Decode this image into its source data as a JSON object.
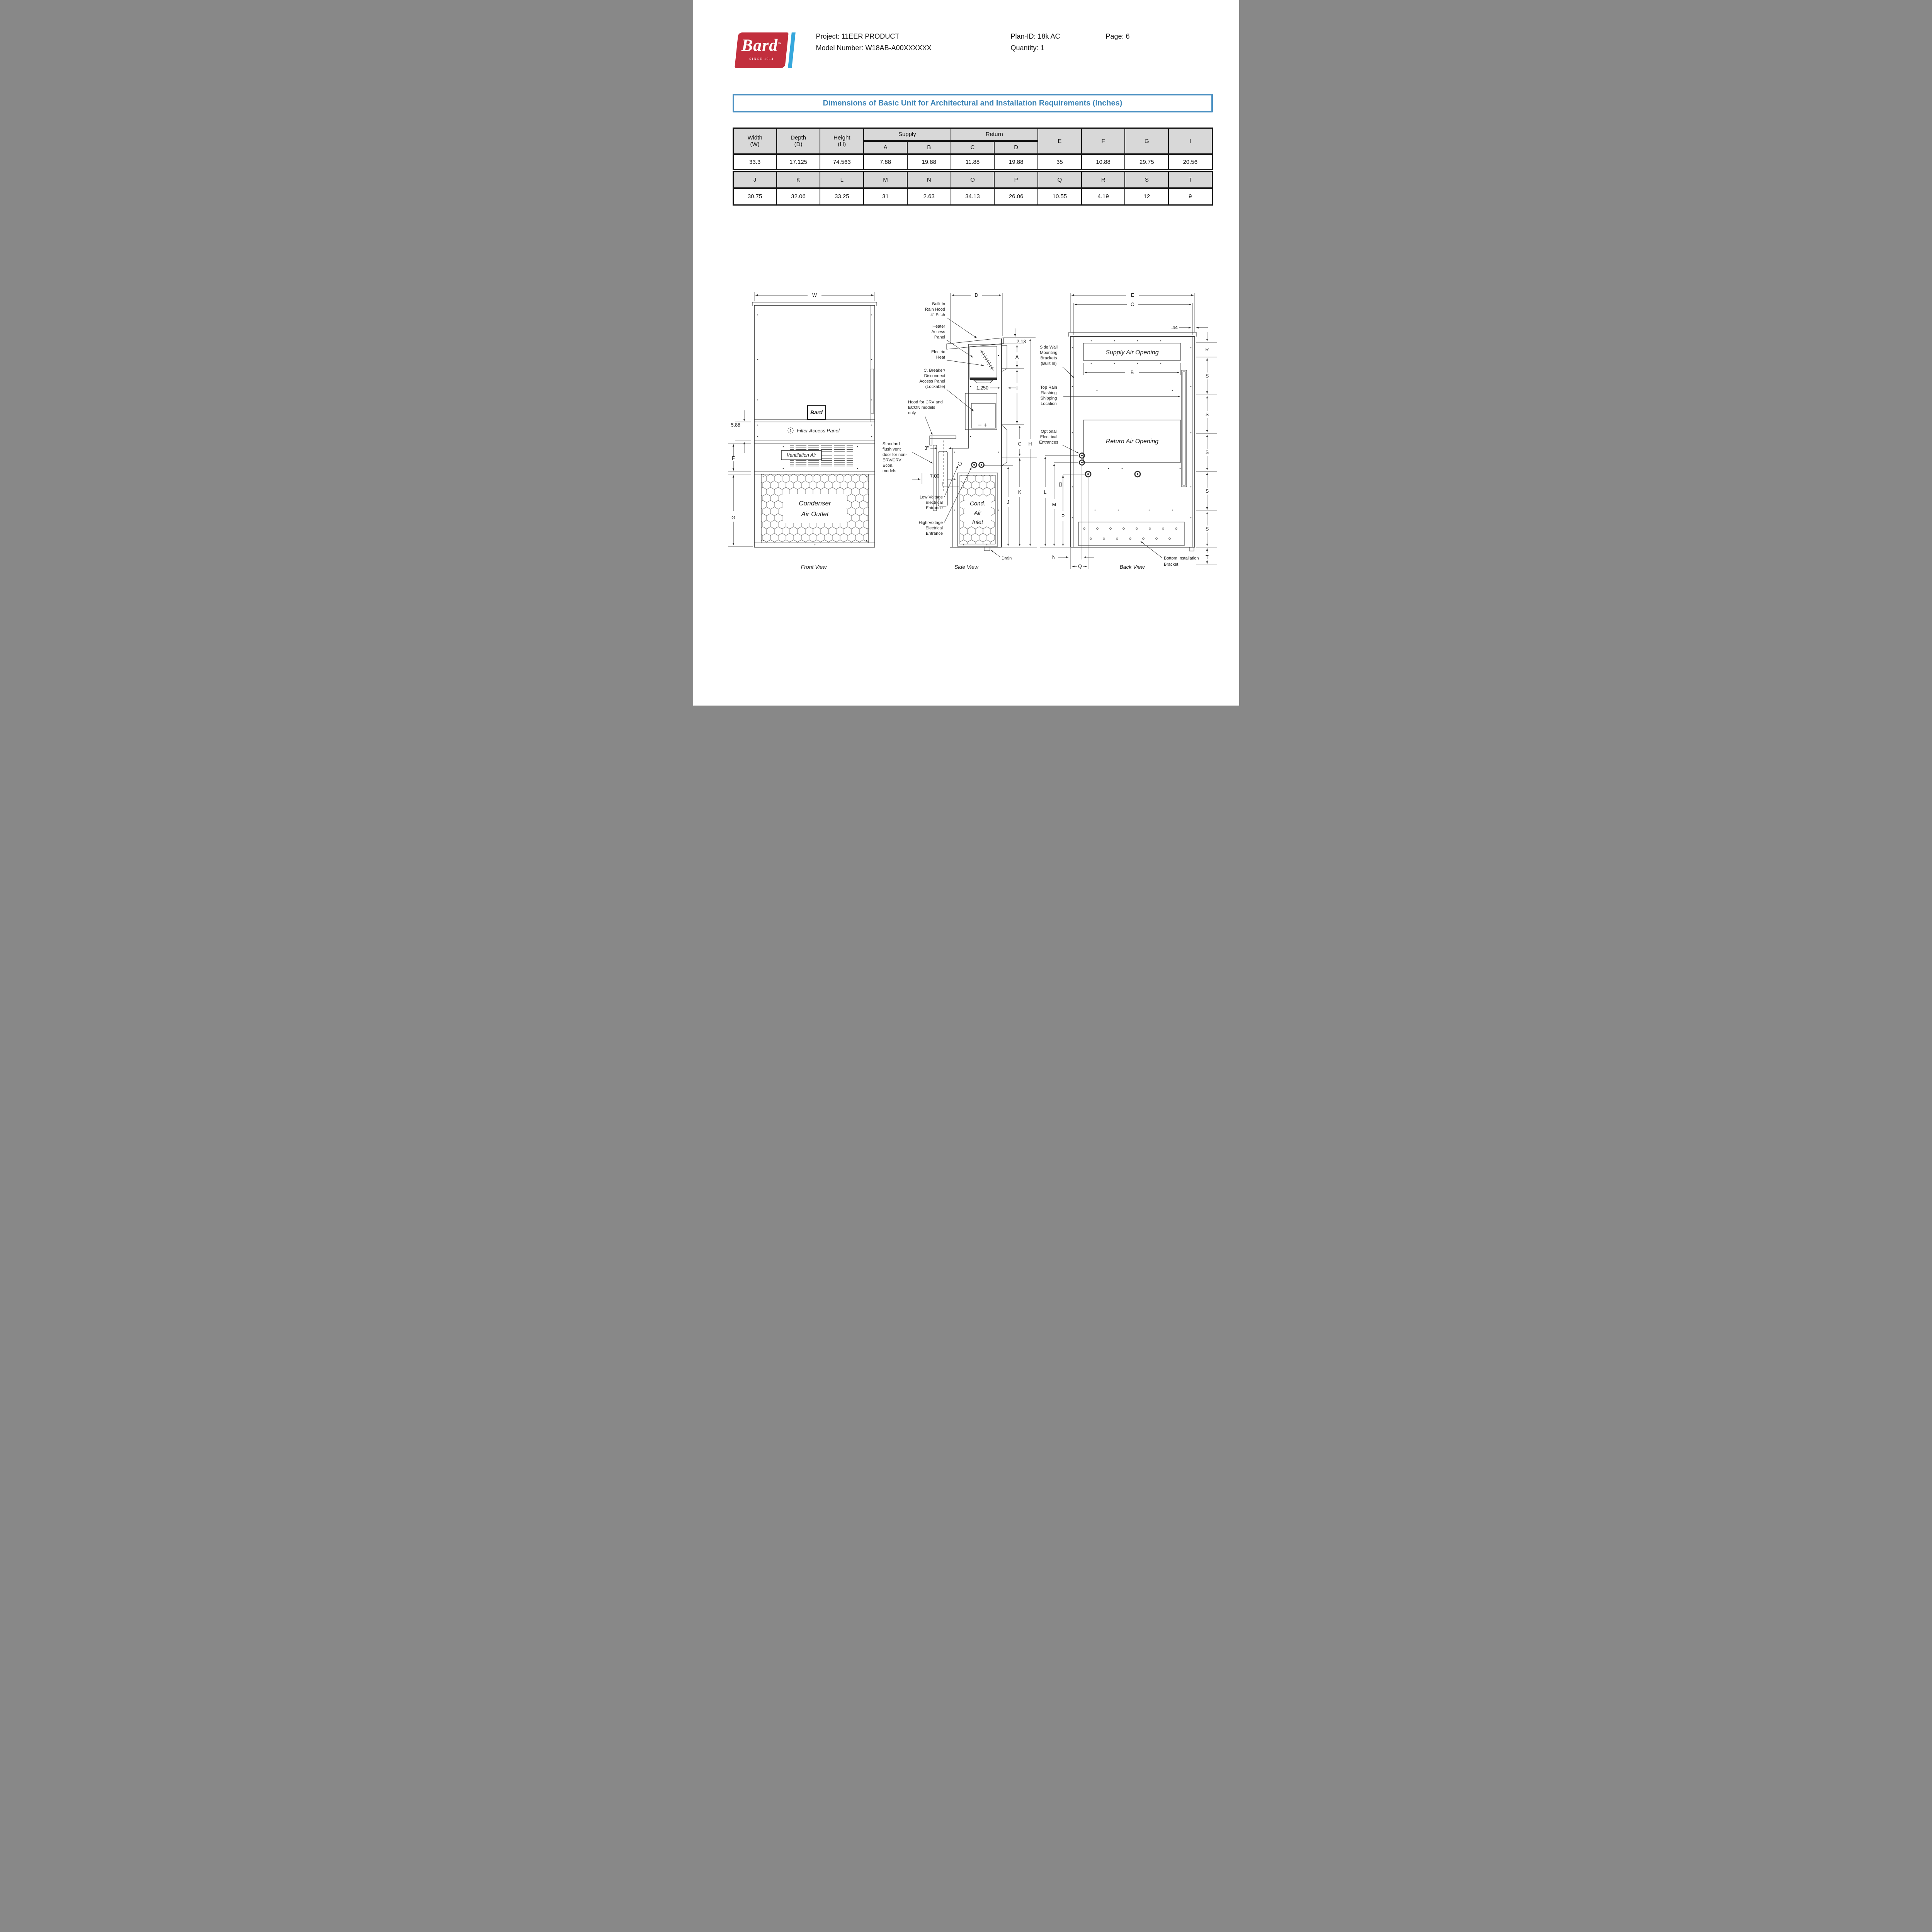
{
  "colors": {
    "accent_blue": "#3e86b8",
    "border_blue": "#4a90c2",
    "bard_red": "#c22f3d",
    "stripe_blue": "#35a7dc",
    "table_header_gray": "#d8d8d8",
    "line_dark": "#2b2b2b"
  },
  "header": {
    "brand": "Bard",
    "trademark": "™",
    "tagline": "SINCE 1914",
    "project": "Project: 11EER PRODUCT",
    "model": "Model Number: W18AB-A00XXXXXX",
    "plan_id": "Plan-ID: 18k AC",
    "page": "Page: 6",
    "quantity": "Quantity: 1"
  },
  "title": "Dimensions of Basic Unit for Architectural and Installation Requirements (Inches)",
  "t1": {
    "width": [
      "Width",
      "(W)"
    ],
    "depth": [
      "Depth",
      "(D)"
    ],
    "height": [
      "Height",
      "(H)"
    ],
    "supply": "Supply",
    "return": "Return",
    "sub": [
      "A",
      "B",
      "C",
      "D"
    ],
    "tail": [
      "E",
      "F",
      "G",
      "I"
    ],
    "vals": [
      "33.3",
      "17.125",
      "74.563",
      "7.88",
      "19.88",
      "11.88",
      "19.88",
      "35",
      "10.88",
      "29.75",
      "20.56"
    ]
  },
  "t2": {
    "heads": [
      "J",
      "K",
      "L",
      "M",
      "N",
      "O",
      "P",
      "Q",
      "R",
      "S",
      "T"
    ],
    "vals": [
      "30.75",
      "32.06",
      "33.25",
      "31",
      "2.63",
      "34.13",
      "26.06",
      "10.55",
      "4.19",
      "12",
      "9"
    ]
  },
  "front": {
    "caption": "Front View",
    "dim_w": "W",
    "dim_588": "5.88",
    "dim_f": "F",
    "dim_g": "G",
    "filter_num": "1",
    "filter_panel": "Filter Access Panel",
    "ventilation": "Ventilation Air",
    "condenser": [
      "Condenser",
      "Air Outlet"
    ],
    "logo": "Bard"
  },
  "side": {
    "caption": "Side View",
    "dim_d": "D",
    "dim_213": "2.13",
    "dim_a": "A",
    "dim_1250": "1.250",
    "dim_i": "I",
    "dim_c": "C",
    "dim_h": "H",
    "dim_k": "K",
    "dim_j": "J",
    "dim_3in": "3\"",
    "dim_700": "7.00",
    "drain": "Drain",
    "inlet": [
      "Cond.",
      "Air",
      "Inlet"
    ],
    "rain_hood": [
      "Built In",
      "Rain Hood",
      "4° Pitch"
    ],
    "heater": [
      "Heater",
      "Access",
      "Panel"
    ],
    "electric_heat": [
      "Electric",
      "Heat"
    ],
    "breaker": [
      "C. Breaker/",
      "Disconnect",
      "Access Panel",
      "(Lockable)"
    ],
    "crv_hood": [
      "Hood for CRV and",
      "ECON models",
      "only"
    ],
    "flush_vent": [
      "Standard",
      "flush vent",
      "door for non-",
      "ERV/CRV",
      "Econ.",
      "models"
    ],
    "low_voltage": [
      "Low Voltage",
      "Electrical",
      "Entrance"
    ],
    "high_voltage": [
      "High Voltage",
      "Electrical",
      "Entrance"
    ]
  },
  "back": {
    "caption": "Back View",
    "dim_e": "E",
    "dim_o": "O",
    "dim_44": ".44",
    "dim_b": "B",
    "dim_r": "R",
    "dim_s": "S",
    "dim_t": "T",
    "dim_l": "L",
    "dim_m": "M",
    "dim_p": "P",
    "dim_n": "N",
    "dim_q": "Q",
    "supply_opening": "Supply Air Opening",
    "return_opening": "Return Air Opening",
    "side_wall": [
      "Side Wall",
      "Mounting",
      "Brackets",
      "(Built In)"
    ],
    "top_rain": [
      "Top Rain",
      "Flashing",
      "Shipping",
      "Location"
    ],
    "optional_elec": [
      "Optional",
      "Electrical",
      "Entrances"
    ],
    "bottom_bracket": [
      "Bottom Installation",
      "Bracket"
    ]
  }
}
